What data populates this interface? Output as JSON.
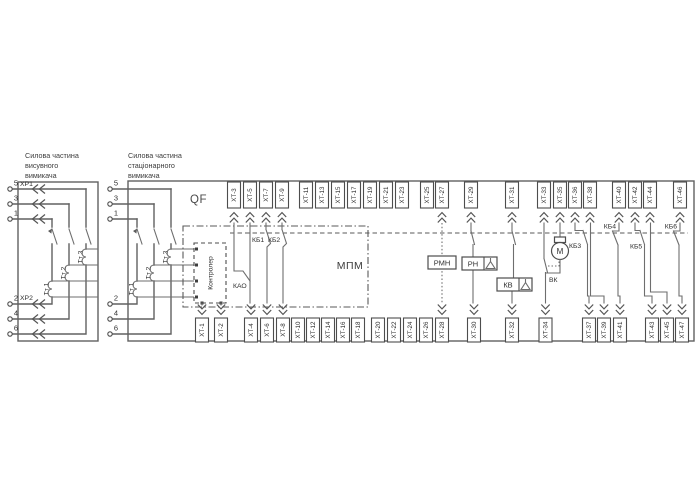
{
  "diagram": {
    "titles": {
      "withdrawable": [
        "Силова частина",
        "висувного",
        "вимикача"
      ],
      "stationary": [
        "Силова частина",
        "стаціонарного",
        "вимикача"
      ]
    },
    "breaker_label": "QF",
    "module_label": "МПМ",
    "controller_label": "Контролер",
    "plug_connectors": {
      "xp1": "ХР1",
      "xp2": "ХР2"
    },
    "pin_numbers": [
      "5",
      "3",
      "1",
      "2",
      "4",
      "6"
    ],
    "current_transformers": [
      "Тт 1",
      "Тт 2",
      "Тт 3"
    ],
    "contacts": {
      "kao": "КАО",
      "kb1": "КБ1",
      "kb2": "КБ2",
      "kb3": "КБ3",
      "kb4": "КБ4",
      "kb5": "КБ5",
      "kb6": "КБ6",
      "vk": "ВК"
    },
    "devices": {
      "rmn": "РМН",
      "rn": "РН",
      "kv": "КВ",
      "motor": "М"
    },
    "top_terminals": [
      {
        "label": "ХТ-3",
        "x": 234,
        "wire": "solid"
      },
      {
        "label": "ХТ-5",
        "x": 250,
        "wire": "solid"
      },
      {
        "label": "ХТ-7",
        "x": 266,
        "wire": "solid"
      },
      {
        "label": "ХТ-9",
        "x": 282,
        "wire": "solid"
      },
      {
        "label": "ХТ-11",
        "x": 306,
        "wire": "none"
      },
      {
        "label": "ХТ-13",
        "x": 322,
        "wire": "none"
      },
      {
        "label": "ХТ-15",
        "x": 338,
        "wire": "none"
      },
      {
        "label": "ХТ-17",
        "x": 354,
        "wire": "none"
      },
      {
        "label": "ХТ-19",
        "x": 370,
        "wire": "none"
      },
      {
        "label": "ХТ-21",
        "x": 386,
        "wire": "none"
      },
      {
        "label": "ХТ-23",
        "x": 402,
        "wire": "none"
      },
      {
        "label": "ХТ-25",
        "x": 427,
        "wire": "none"
      },
      {
        "label": "ХТ-27",
        "x": 442,
        "wire": "dotted"
      },
      {
        "label": "ХТ-29",
        "x": 471,
        "wire": "solid"
      },
      {
        "label": "ХТ-31",
        "x": 512,
        "wire": "solid"
      },
      {
        "label": "ХТ-33",
        "x": 544,
        "wire": "solid"
      },
      {
        "label": "ХТ-35",
        "x": 560,
        "wire": "solid"
      },
      {
        "label": "ХТ-36",
        "x": 575,
        "wire": "solid"
      },
      {
        "label": "ХТ-38",
        "x": 590,
        "wire": "solid"
      },
      {
        "label": "ХТ-40",
        "x": 619,
        "wire": "solid"
      },
      {
        "label": "ХТ-42",
        "x": 635,
        "wire": "solid"
      },
      {
        "label": "ХТ-44",
        "x": 650,
        "wire": "solid"
      },
      {
        "label": "ХТ-46",
        "x": 680,
        "wire": "solid"
      }
    ],
    "bottom_terminals": [
      {
        "label": "ХТ-1",
        "x": 202,
        "wire": "solid"
      },
      {
        "label": "ХТ-2",
        "x": 221,
        "wire": "solid"
      },
      {
        "label": "ХТ-4",
        "x": 251,
        "wire": "solid"
      },
      {
        "label": "ХТ-6",
        "x": 267,
        "wire": "solid"
      },
      {
        "label": "ХТ-8",
        "x": 283,
        "wire": "solid"
      },
      {
        "label": "ХТ-10",
        "x": 298,
        "wire": "none"
      },
      {
        "label": "ХТ-12",
        "x": 313,
        "wire": "none"
      },
      {
        "label": "ХТ-14",
        "x": 328,
        "wire": "none"
      },
      {
        "label": "ХТ-16",
        "x": 343,
        "wire": "none"
      },
      {
        "label": "ХТ-18",
        "x": 358,
        "wire": "none"
      },
      {
        "label": "ХТ-20",
        "x": 378,
        "wire": "none"
      },
      {
        "label": "ХТ-22",
        "x": 394,
        "wire": "none"
      },
      {
        "label": "ХТ-24",
        "x": 410,
        "wire": "none"
      },
      {
        "label": "ХТ-26",
        "x": 426,
        "wire": "none"
      },
      {
        "label": "ХТ-28",
        "x": 442,
        "wire": "dotted"
      },
      {
        "label": "ХТ-30",
        "x": 474,
        "wire": "solid"
      },
      {
        "label": "ХТ-32",
        "x": 512,
        "wire": "solid"
      },
      {
        "label": "ХТ-34",
        "x": 545.5,
        "wire": "solid"
      },
      {
        "label": "ХТ-37",
        "x": 589,
        "wire": "solid"
      },
      {
        "label": "ХТ-39",
        "x": 604,
        "wire": "solid"
      },
      {
        "label": "ХТ-41",
        "x": 620,
        "wire": "solid"
      },
      {
        "label": "ХТ-43",
        "x": 652,
        "wire": "solid"
      },
      {
        "label": "ХТ-45",
        "x": 667,
        "wire": "solid"
      },
      {
        "label": "ХТ-47",
        "x": 682,
        "wire": "solid"
      }
    ],
    "colors": {
      "line": "#606060",
      "control_line": "#6e6e6e",
      "text": "#333333",
      "background": "#ffffff"
    }
  }
}
